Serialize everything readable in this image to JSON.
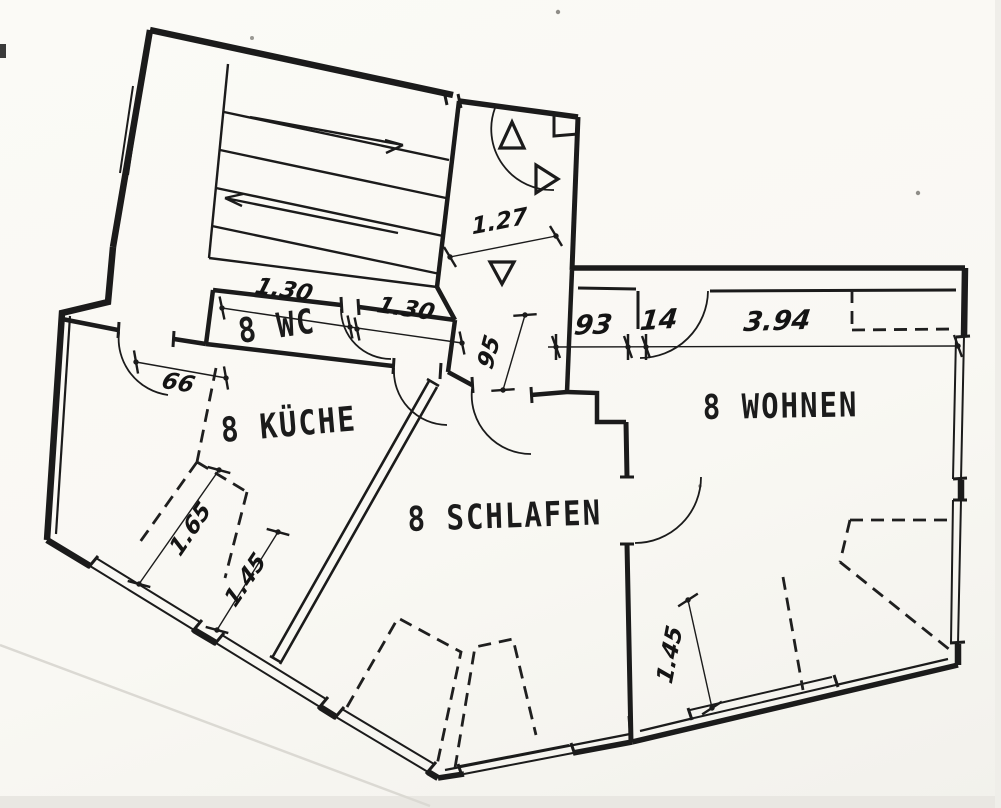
{
  "drawing": {
    "kind": "scanned apartment floor plan",
    "colors": {
      "ink": "#1b1b1b",
      "paper": "#f9f8f4"
    }
  },
  "rooms": [
    {
      "name": "wc",
      "label": "8 WC"
    },
    {
      "name": "kueche",
      "label": "8 KÜCHE"
    },
    {
      "name": "schlafen",
      "label": "8 SCHLAFEN"
    },
    {
      "name": "wohnen",
      "label": "8 WOHNEN"
    }
  ],
  "dims": [
    {
      "name": "wc-left-width",
      "value": "1.30"
    },
    {
      "name": "wc-right-width",
      "value": "1.30"
    },
    {
      "name": "entry-hall-width",
      "value": "1.27"
    },
    {
      "name": "corridor-width",
      "value": "95"
    },
    {
      "name": "wohnen-door-offset",
      "value": "93"
    },
    {
      "name": "wohnen-wall",
      "value": "14"
    },
    {
      "name": "wohnen-width",
      "value": "3.94"
    },
    {
      "name": "kueche-door-width",
      "value": "66"
    },
    {
      "name": "kueche-slope-depth",
      "value": "1.65"
    },
    {
      "name": "kueche-slope-inner",
      "value": "1.45"
    },
    {
      "name": "wohnen-slope-depth",
      "value": "1.45"
    }
  ]
}
